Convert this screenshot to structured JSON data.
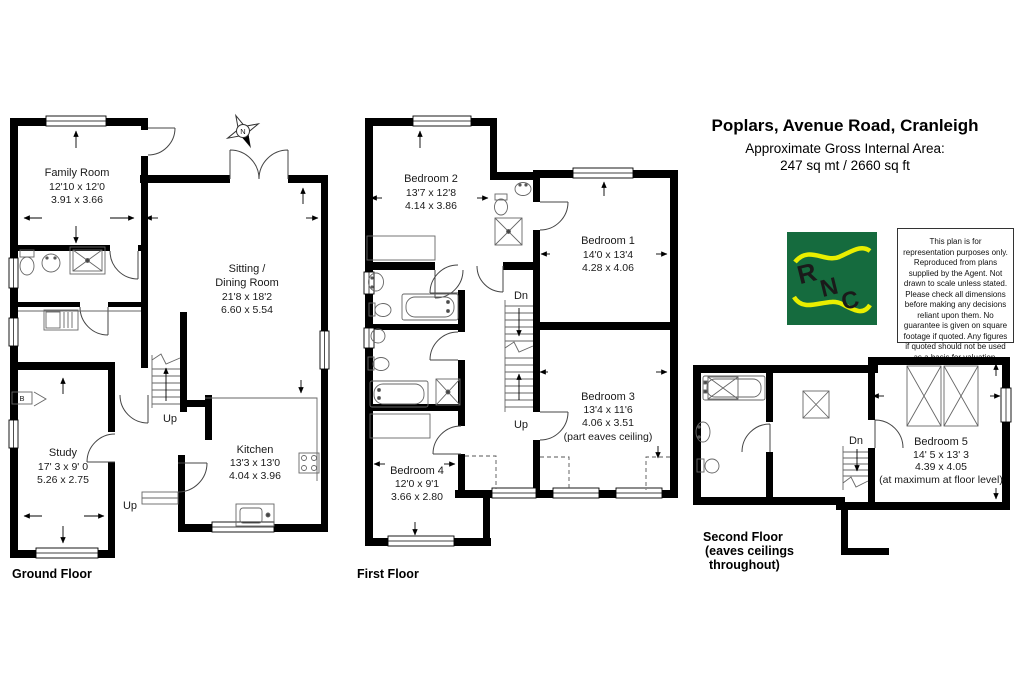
{
  "header": {
    "title": "Poplars, Avenue Road, Cranleigh",
    "subtitle_line1": "Approximate Gross Internal Area:",
    "subtitle_line2": "247 sq mt  / 2660 sq ft"
  },
  "logo": {
    "letters": [
      "R",
      "N",
      "C"
    ],
    "background": "#156b3e",
    "foreground": "#e9ee00"
  },
  "disclaimer": "This plan is for representation purposes only. Reproduced from plans supplied by the Agent. Not drawn to scale unless stated. Please check all dimensions before making any decisions reliant upon them. No guarantee is given on square footage if quoted. Any figures if quoted should not be used as a basis for valuation.",
  "compass": {
    "north": "N"
  },
  "ground_floor": {
    "label": "Ground Floor",
    "family_room": {
      "name": "Family Room",
      "imperial": "12'10 x 12'0",
      "metric": "3.91 x 3.66"
    },
    "sitting_dining": {
      "name_line1": "Sitting /",
      "name_line2": "Dining Room",
      "imperial": "21'8 x 18'2",
      "metric": "6.60 x 5.54"
    },
    "study": {
      "name": "Study",
      "imperial": "17' 3 x 9' 0",
      "metric": "5.26 x 2.75"
    },
    "kitchen": {
      "name": "Kitchen",
      "imperial": "13'3 x 13'0",
      "metric": "4.04 x 3.96"
    },
    "stairs_up": "Up",
    "step_up": "Up",
    "boiler": "B"
  },
  "first_floor": {
    "label": "First Floor",
    "bedroom2": {
      "name": "Bedroom 2",
      "imperial": "13'7 x 12'8",
      "metric": "4.14 x 3.86"
    },
    "bedroom1": {
      "name": "Bedroom 1",
      "imperial": "14'0 x 13'4",
      "metric": "4.28 x 4.06"
    },
    "bedroom3": {
      "name": "Bedroom 3",
      "imperial": "13'4 x 11'6",
      "metric": "4.06 x 3.51",
      "note": "(part eaves ceiling)"
    },
    "bedroom4": {
      "name": "Bedroom 4",
      "imperial": "12'0 x 9'1",
      "metric": "3.66 x 2.80"
    },
    "stairs_dn": "Dn",
    "stairs_up": "Up"
  },
  "second_floor": {
    "label_line1": "Second Floor",
    "label_line2": "(eaves ceilings",
    "label_line3": "throughout)",
    "bedroom5": {
      "name": "Bedroom 5",
      "imperial": "14' 5 x 13' 3",
      "metric": "4.39 x 4.05",
      "note": "(at maximum at floor level)"
    },
    "stairs_dn": "Dn"
  }
}
